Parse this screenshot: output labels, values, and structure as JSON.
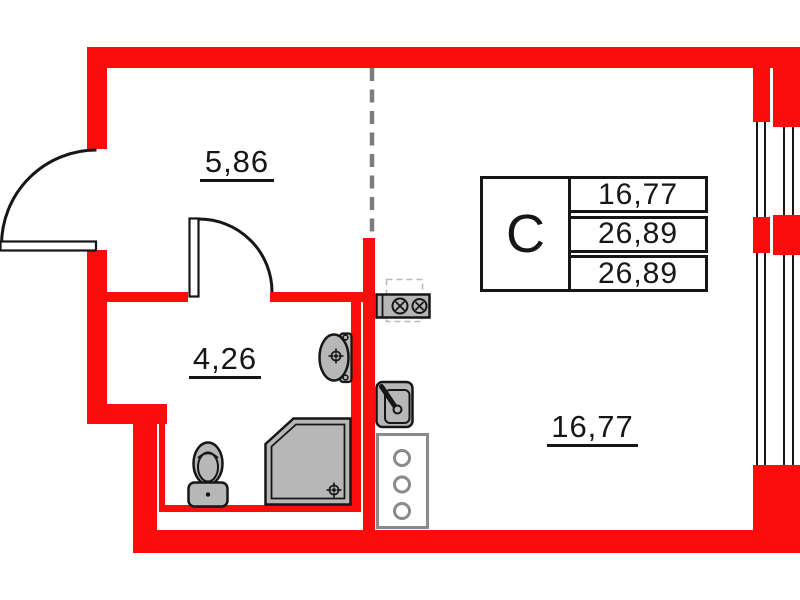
{
  "plan": {
    "rooms": [
      {
        "name": "hallway",
        "area": "5,86"
      },
      {
        "name": "bathroom",
        "area": "4,26"
      },
      {
        "name": "living-room",
        "area": "16,77"
      }
    ],
    "info_table": {
      "type_label": "C",
      "rows": [
        "16,77",
        "26,89",
        "26,89"
      ]
    },
    "fixtures": [
      "entry-door",
      "interior-door",
      "toilet",
      "shower",
      "bathroom-sink",
      "stove",
      "extractor-hood-outline",
      "kitchen-sink",
      "utility-shaft"
    ],
    "colors": {
      "wall": "#fb0d0c",
      "line": "#161616",
      "fixture_fill": "#b7b7b7",
      "cabinet_stroke": "#8a8a8a",
      "dashed_divider": "#7d7d7d"
    }
  }
}
